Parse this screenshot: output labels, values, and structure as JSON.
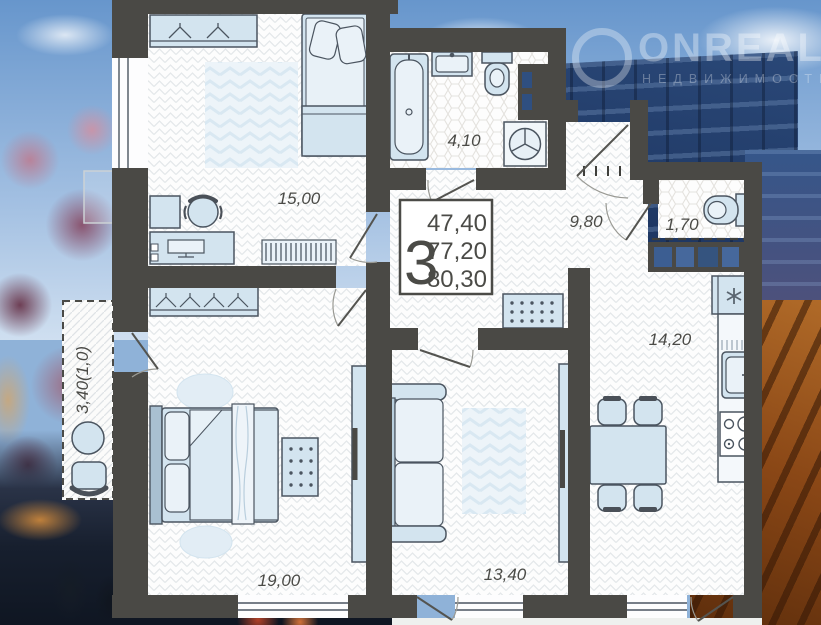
{
  "watermark": {
    "brand": "ONREAL",
    "tagline": "НЕДВИЖИМОСТЬ"
  },
  "info_box": {
    "room_count": "3",
    "areas": [
      "47,40",
      "77,20",
      "80,30"
    ]
  },
  "rooms": {
    "bedroom_top": {
      "label": "15,00"
    },
    "bathroom": {
      "label": "4,10"
    },
    "hallway": {
      "label": "9,80"
    },
    "wc": {
      "label": "1,70"
    },
    "kitchen": {
      "label": "14,20"
    },
    "bedroom_main": {
      "label": "19,00"
    },
    "living": {
      "label": "13,40"
    },
    "balcony": {
      "label": "3,40(1,0)"
    }
  },
  "colors": {
    "wall": "#4a4945",
    "furniture_fill": "#d3e4ef",
    "loggia_glass": "#3c5e92"
  }
}
